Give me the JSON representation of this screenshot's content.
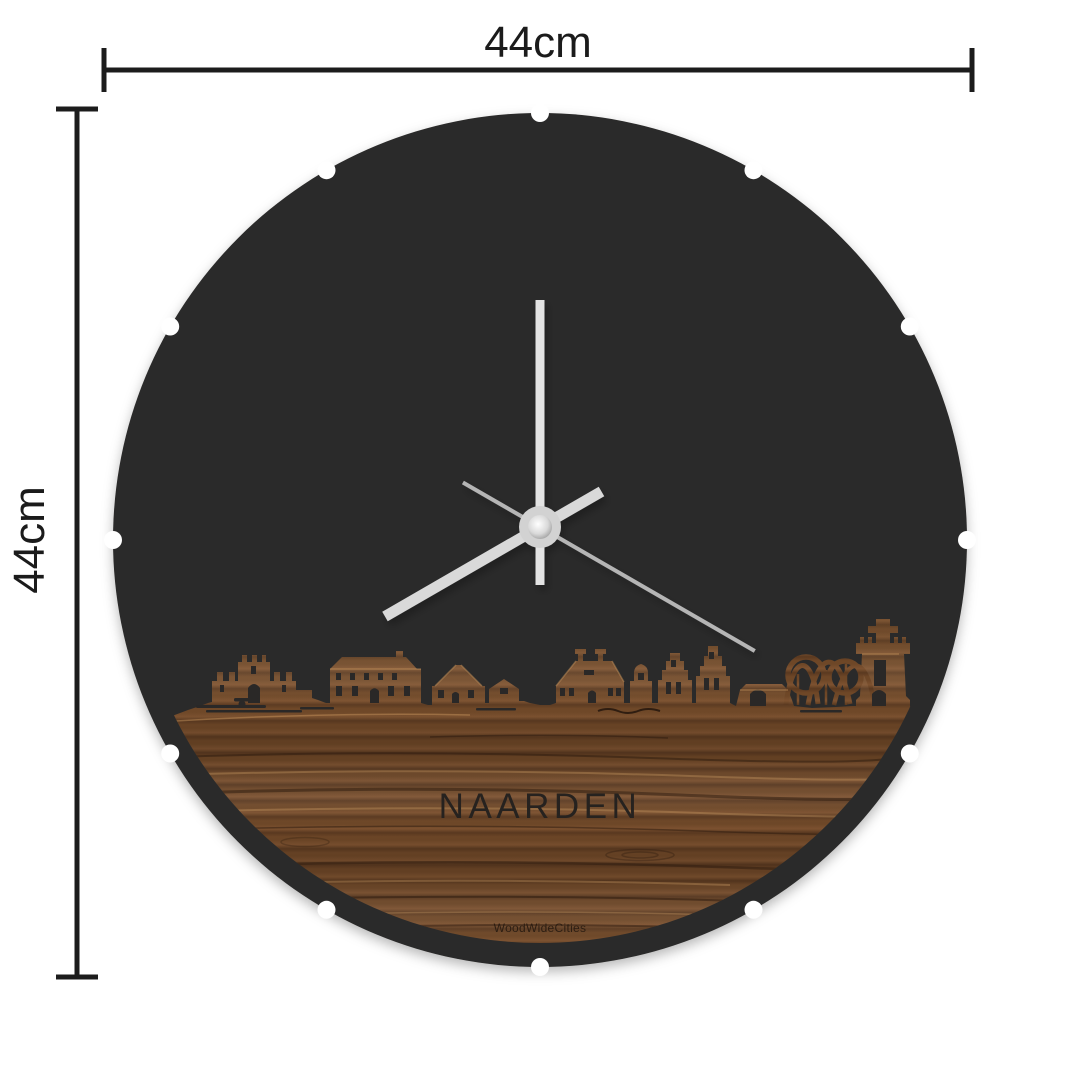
{
  "product": {
    "type": "round wall clock with city skyline",
    "city_label": "NAARDEN",
    "brand_label": "WoodWideCities"
  },
  "dimension_annotations": {
    "width": {
      "label": "44cm"
    },
    "height": {
      "label": "44cm"
    },
    "line_color": "#1c1c1c"
  },
  "clock": {
    "face_color": "#2b2a29",
    "cutout_color": "#2a2827",
    "hour_notch_count": 12,
    "wood": {
      "base": "#6e4727",
      "light": "#7d5230",
      "dark": "#5a3920",
      "highlight": "#8f6038"
    },
    "hands": {
      "minute": {
        "angle_deg": 0,
        "color": "#e3e3e3"
      },
      "hour": {
        "angle_deg": 240,
        "color": "#d9d9d9"
      },
      "second": {
        "angle_deg": 120,
        "color": "#b5b5b5"
      },
      "hub_color": "#d2d2d2"
    }
  }
}
